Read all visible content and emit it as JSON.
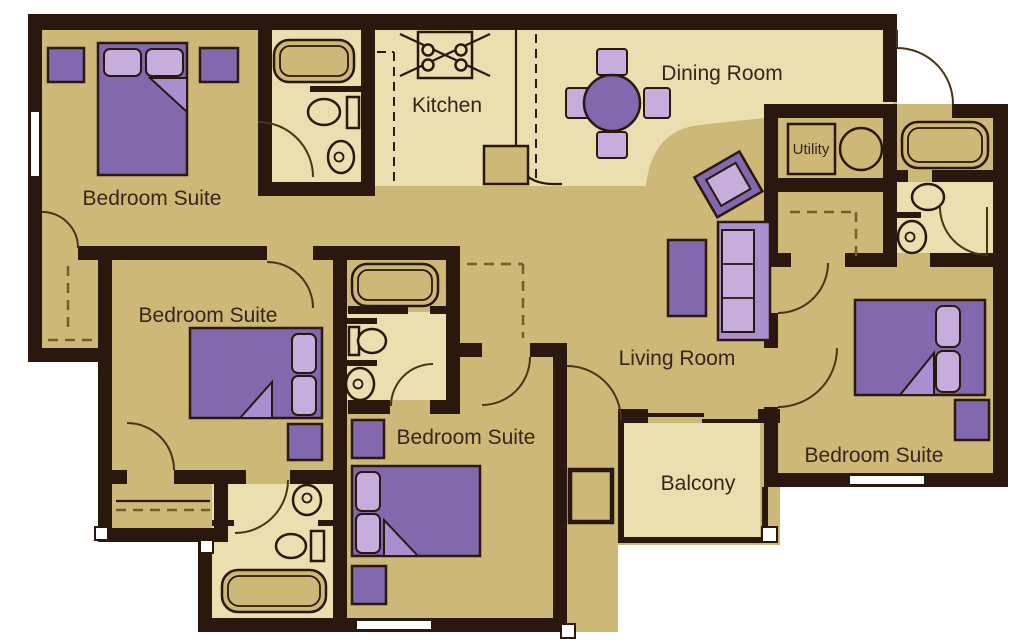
{
  "image": {
    "type": "apartment-floor-plan",
    "description": "Four bedroom suite apartment floor plan with kitchen, dining room, living room, utility room and balcony"
  },
  "colors": {
    "wall": "#2a170d",
    "floor": "#cdb877",
    "floor_light": "#ebdfb0",
    "purple": "#8268ac",
    "purple_mid": "#a98fd0",
    "purple_light": "#c6addc",
    "line": "#2a170d",
    "door": "#4a3418",
    "dash": "#7a5a30",
    "text": "#33261a",
    "background": "#ffffff"
  },
  "rooms": [
    {
      "id": "bedroom-suite-1",
      "label": "Bedroom Suite"
    },
    {
      "id": "kitchen",
      "label": "Kitchen"
    },
    {
      "id": "dining-room",
      "label": "Dining Room"
    },
    {
      "id": "utility",
      "label": "Utility"
    },
    {
      "id": "bedroom-suite-2",
      "label": "Bedroom Suite"
    },
    {
      "id": "bedroom-suite-3",
      "label": "Bedroom Suite"
    },
    {
      "id": "living-room",
      "label": "Living Room"
    },
    {
      "id": "balcony",
      "label": "Balcony"
    },
    {
      "id": "bedroom-suite-4",
      "label": "Bedroom Suite"
    }
  ],
  "furniture_icons": [
    "double-bed-icon",
    "pillow-icon",
    "nightstand-icon",
    "bathtub-icon",
    "toilet-icon",
    "sink-icon",
    "stove-icon",
    "kitchen-counter-icon",
    "dining-table-icon",
    "dining-chair-icon",
    "sofa-icon",
    "coffee-table-icon",
    "accent-table-icon",
    "washer-icon",
    "dryer-icon",
    "closet-rod-icon",
    "door-swing-icon",
    "window-icon",
    "sliding-door-icon",
    "corner-post-icon"
  ]
}
